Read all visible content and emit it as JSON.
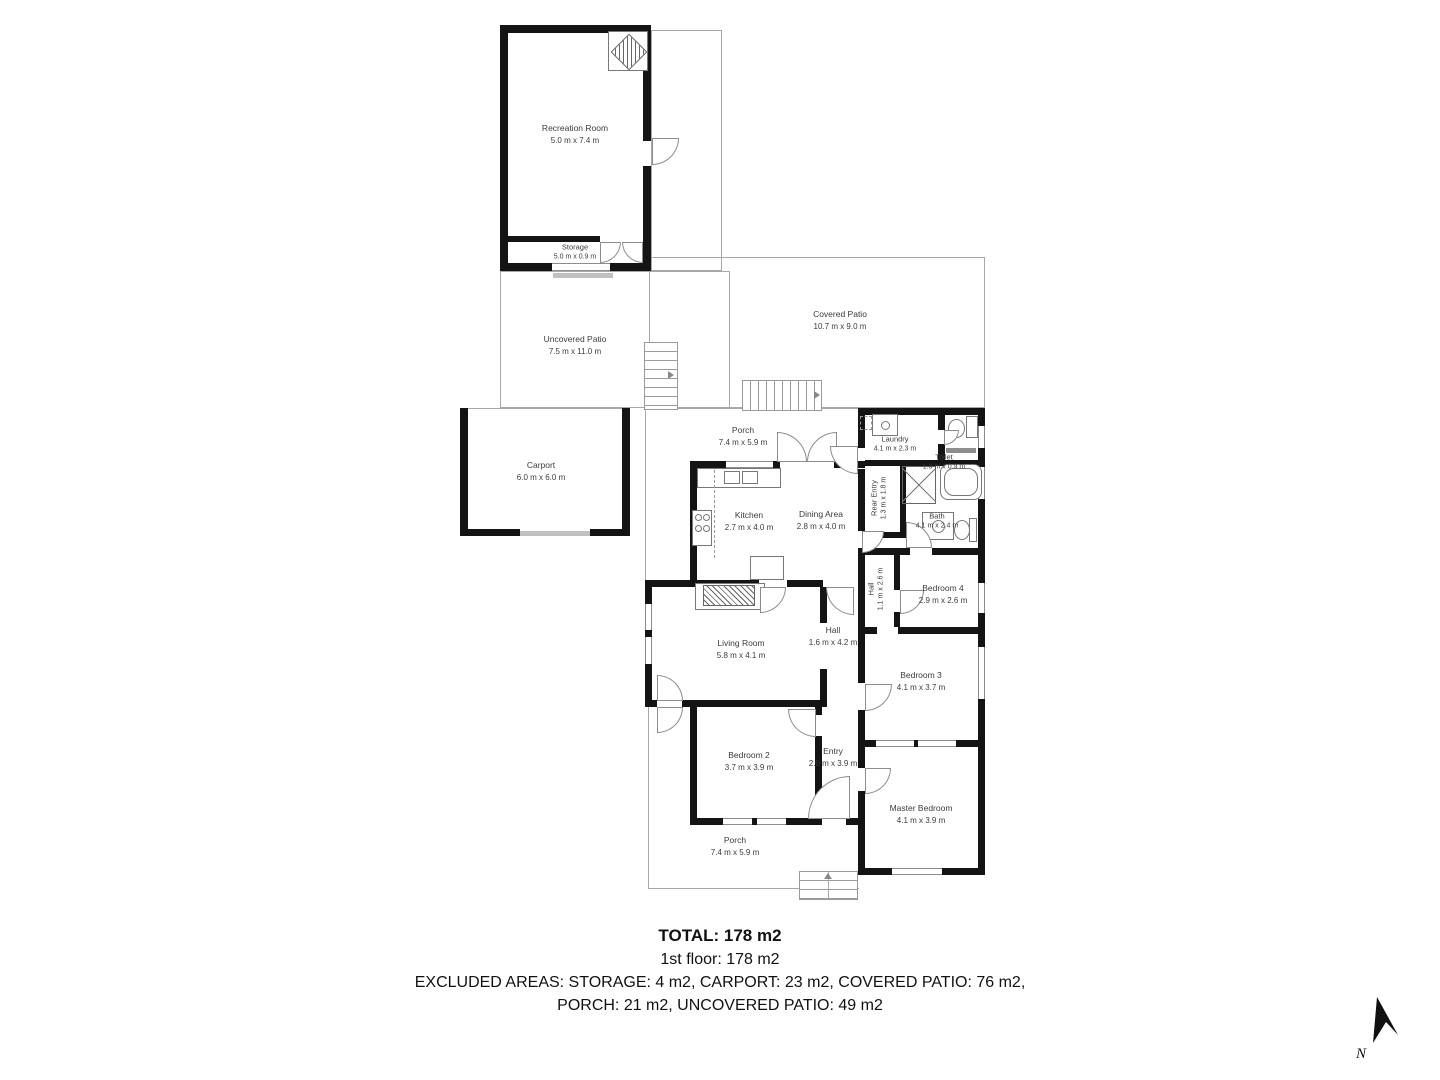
{
  "rooms": {
    "recreation_room": {
      "name": "Recreation Room",
      "dims": "5.0 m x 7.4 m"
    },
    "storage": {
      "name": "Storage",
      "dims": "5.0 m x 0.9 m"
    },
    "uncovered_patio": {
      "name": "Uncovered Patio",
      "dims": "7.5 m x 11.0 m"
    },
    "covered_patio": {
      "name": "Covered Patio",
      "dims": "10.7 m x 9.0 m"
    },
    "carport": {
      "name": "Carport",
      "dims": "6.0 m x 6.0 m"
    },
    "porch_top": {
      "name": "Porch",
      "dims": "7.4 m x 5.9 m"
    },
    "laundry": {
      "name": "Laundry",
      "dims": "4.1 m x 2.3 m"
    },
    "toilet": {
      "name": "Toilet",
      "dims": "1.3 m x 0.9 m"
    },
    "rear_entry": {
      "name": "Rear Entry",
      "dims": "1.3 m x 1.8 m"
    },
    "kitchen": {
      "name": "Kitchen",
      "dims": "2.7 m x 4.0 m"
    },
    "dining_area": {
      "name": "Dining Area",
      "dims": "2.8 m x 4.0 m"
    },
    "bath": {
      "name": "Bath",
      "dims": "4.1 m x 2.4 m"
    },
    "hall_small": {
      "name": "Hall",
      "dims": "1.1 m x 2.6 m"
    },
    "bedroom4": {
      "name": "Bedroom 4",
      "dims": "2.9 m x 2.6 m"
    },
    "living_room": {
      "name": "Living Room",
      "dims": "5.8 m x 4.1 m"
    },
    "hall_main": {
      "name": "Hall",
      "dims": "1.6 m x 4.2 m"
    },
    "bedroom3": {
      "name": "Bedroom 3",
      "dims": "4.1 m x 3.7 m"
    },
    "bedroom2": {
      "name": "Bedroom 2",
      "dims": "3.7 m x 3.9 m"
    },
    "entry": {
      "name": "Entry",
      "dims": "2.0 m x 3.9 m"
    },
    "master_bedroom": {
      "name": "Master Bedroom",
      "dims": "4.1 m x 3.9 m"
    },
    "porch_bottom": {
      "name": "Porch",
      "dims": "7.4 m x 5.9 m"
    }
  },
  "footer": {
    "total": "TOTAL: 178 m2",
    "floor": "1st floor: 178 m2",
    "excluded_line1": "EXCLUDED AREAS: STORAGE: 4 m2, CARPORT: 23 m2, COVERED PATIO: 76 m2,",
    "excluded_line2": "PORCH: 21 m2, UNCOVERED PATIO: 49 m2"
  },
  "compass": {
    "label": "N"
  },
  "colors": {
    "wall": "#141414",
    "thin_line": "#a8a8a8",
    "text": "#3b3b3b"
  }
}
